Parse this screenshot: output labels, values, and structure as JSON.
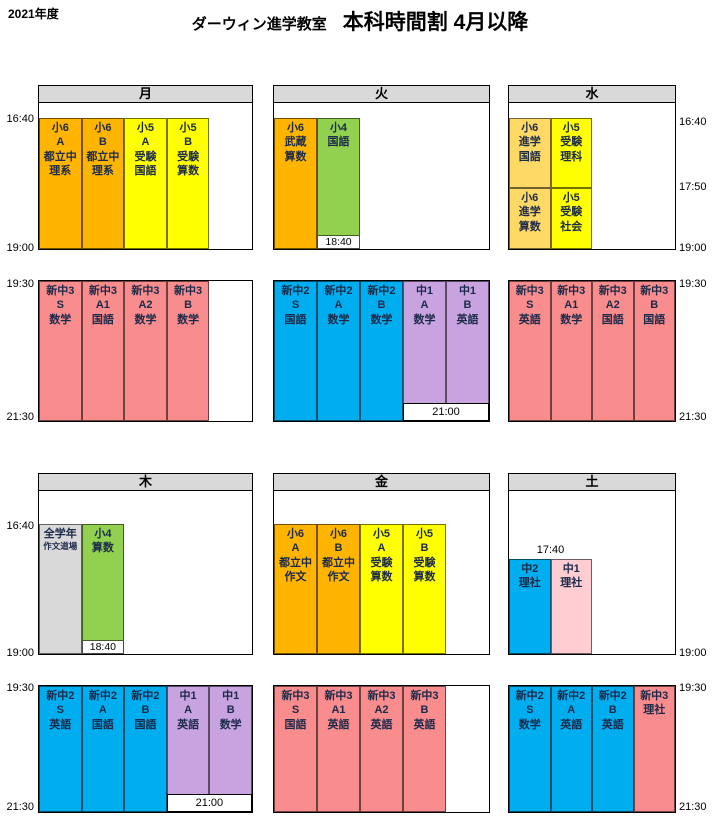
{
  "title": {
    "year": "2021年度",
    "school": "ダーウィン進学教室",
    "heading": "本科時間割 4月以降"
  },
  "colors": {
    "orange": "#FFB400",
    "yellow": "#FFFF00",
    "gold": "#FFD966",
    "green": "#92D050",
    "pink": "#F98C8C",
    "blue": "#00AEEF",
    "purple": "#C9A3DF",
    "lightpink": "#FFCDD2",
    "gray": "#D9D9D9",
    "header_bg": "#D9D9D9",
    "cell_text": "#1B2A4A"
  },
  "time_labels": {
    "t1640": "16:40",
    "t1740": "17:40",
    "t1750": "17:50",
    "t1840": "18:40",
    "t1900": "19:00",
    "t1930": "19:30",
    "t2100": "21:00",
    "t2130": "21:30"
  },
  "days": {
    "mon": {
      "label": "月",
      "afternoon": {
        "cells": [
          {
            "text": "小6\nA\n都立中\n理系",
            "color": "orange"
          },
          {
            "text": "小6\nB\n都立中\n理系",
            "color": "orange"
          },
          {
            "text": "小5\nA\n受験\n国語",
            "color": "yellow"
          },
          {
            "text": "小5\nB\n受験\n算数",
            "color": "yellow"
          }
        ]
      },
      "evening": {
        "cells": [
          {
            "text": "新中3\nS\n数学",
            "color": "pink"
          },
          {
            "text": "新中3\nA1\n国語",
            "color": "pink"
          },
          {
            "text": "新中3\nA2\n数学",
            "color": "pink"
          },
          {
            "text": "新中3\nB\n数学",
            "color": "pink"
          }
        ]
      }
    },
    "tue": {
      "label": "火",
      "afternoon": {
        "end_label": "18:40",
        "cells": [
          {
            "text": "小6\n武蔵\n算数",
            "color": "orange"
          },
          {
            "text": "小4\n国語",
            "color": "green"
          }
        ]
      },
      "evening": {
        "end_label": "21:00",
        "cells": [
          {
            "text": "新中2\nS\n国語",
            "color": "blue"
          },
          {
            "text": "新中2\nA\n数学",
            "color": "blue"
          },
          {
            "text": "新中2\nB\n数学",
            "color": "blue"
          },
          {
            "text": "中1\nA\n数学",
            "color": "purple"
          },
          {
            "text": "中1\nB\n英語",
            "color": "purple"
          }
        ]
      }
    },
    "wed": {
      "label": "水",
      "afternoon": {
        "cells": [
          {
            "text": "小6\n進学\n国語",
            "color": "gold"
          },
          {
            "text": "小6\n進学\n算数",
            "color": "gold"
          },
          {
            "text": "小5\n受験\n理科",
            "color": "yellow"
          },
          {
            "text": "小5\n受験\n社会",
            "color": "yellow"
          }
        ]
      },
      "evening": {
        "cells": [
          {
            "text": "新中3\nS\n英語",
            "color": "pink"
          },
          {
            "text": "新中3\nA1\n数学",
            "color": "pink"
          },
          {
            "text": "新中3\nA2\n国語",
            "color": "pink"
          },
          {
            "text": "新中3\nB\n国語",
            "color": "pink"
          }
        ]
      }
    },
    "thu": {
      "label": "木",
      "afternoon": {
        "end_label": "18:40",
        "cells": [
          {
            "line1": "全学年",
            "line2": "作文道場",
            "color": "gray"
          },
          {
            "text": "小4\n算数",
            "color": "green"
          }
        ]
      },
      "evening": {
        "end_label": "21:00",
        "cells": [
          {
            "text": "新中2\nS\n英語",
            "color": "blue"
          },
          {
            "text": "新中2\nA\n国語",
            "color": "blue"
          },
          {
            "text": "新中2\nB\n国語",
            "color": "blue"
          },
          {
            "text": "中1\nA\n英語",
            "color": "purple"
          },
          {
            "text": "中1\nB\n数学",
            "color": "purple"
          }
        ]
      }
    },
    "fri": {
      "label": "金",
      "afternoon": {
        "cells": [
          {
            "text": "小6\nA\n都立中\n作文",
            "color": "orange"
          },
          {
            "text": "小6\nB\n都立中\n作文",
            "color": "orange"
          },
          {
            "text": "小5\nA\n受験\n算数",
            "color": "yellow"
          },
          {
            "text": "小5\nB\n受験\n算数",
            "color": "yellow"
          }
        ]
      },
      "evening": {
        "cells": [
          {
            "text": "新中3\nS\n国語",
            "color": "pink"
          },
          {
            "text": "新中3\nA1\n英語",
            "color": "pink"
          },
          {
            "text": "新中3\nA2\n英語",
            "color": "pink"
          },
          {
            "text": "新中3\nB\n英語",
            "color": "pink"
          }
        ]
      }
    },
    "sat": {
      "label": "土",
      "afternoon": {
        "start_label": "17:40",
        "cells": [
          {
            "text": "中2\n理社",
            "color": "blue"
          },
          {
            "text": "中1\n理社",
            "color": "lightpink"
          }
        ]
      },
      "evening": {
        "cells": [
          {
            "text": "新中2\nS\n数学",
            "color": "blue"
          },
          {
            "text": "新中2\nA\n英語",
            "color": "blue"
          },
          {
            "text": "新中2\nB\n英語",
            "color": "blue"
          },
          {
            "text": "新中3\n理社",
            "color": "pink"
          }
        ]
      }
    }
  }
}
